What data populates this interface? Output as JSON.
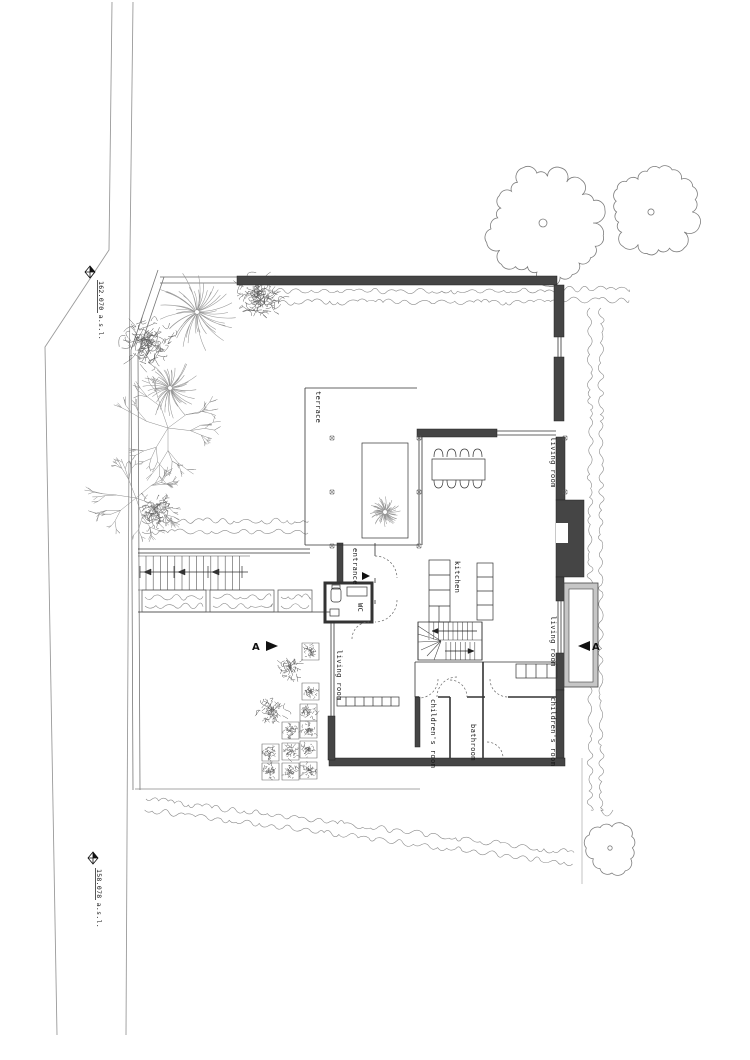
{
  "plan": {
    "rooms": {
      "terrace": "terrace",
      "living_room": "living room",
      "kitchen": "kitchen",
      "entrance": "entrance",
      "wc": "WC",
      "childrens_room": "children's room",
      "bathroom": "bathroom"
    },
    "annotations": {
      "level_upper": "162.070 a.s.l.",
      "level_lower": "158.078 a.s.l.",
      "section_letter": "A"
    },
    "colors": {
      "wall_dark": "#424242",
      "line": "#333333",
      "vegetation": "#858585",
      "slab_gray": "#c6c6c6"
    }
  }
}
